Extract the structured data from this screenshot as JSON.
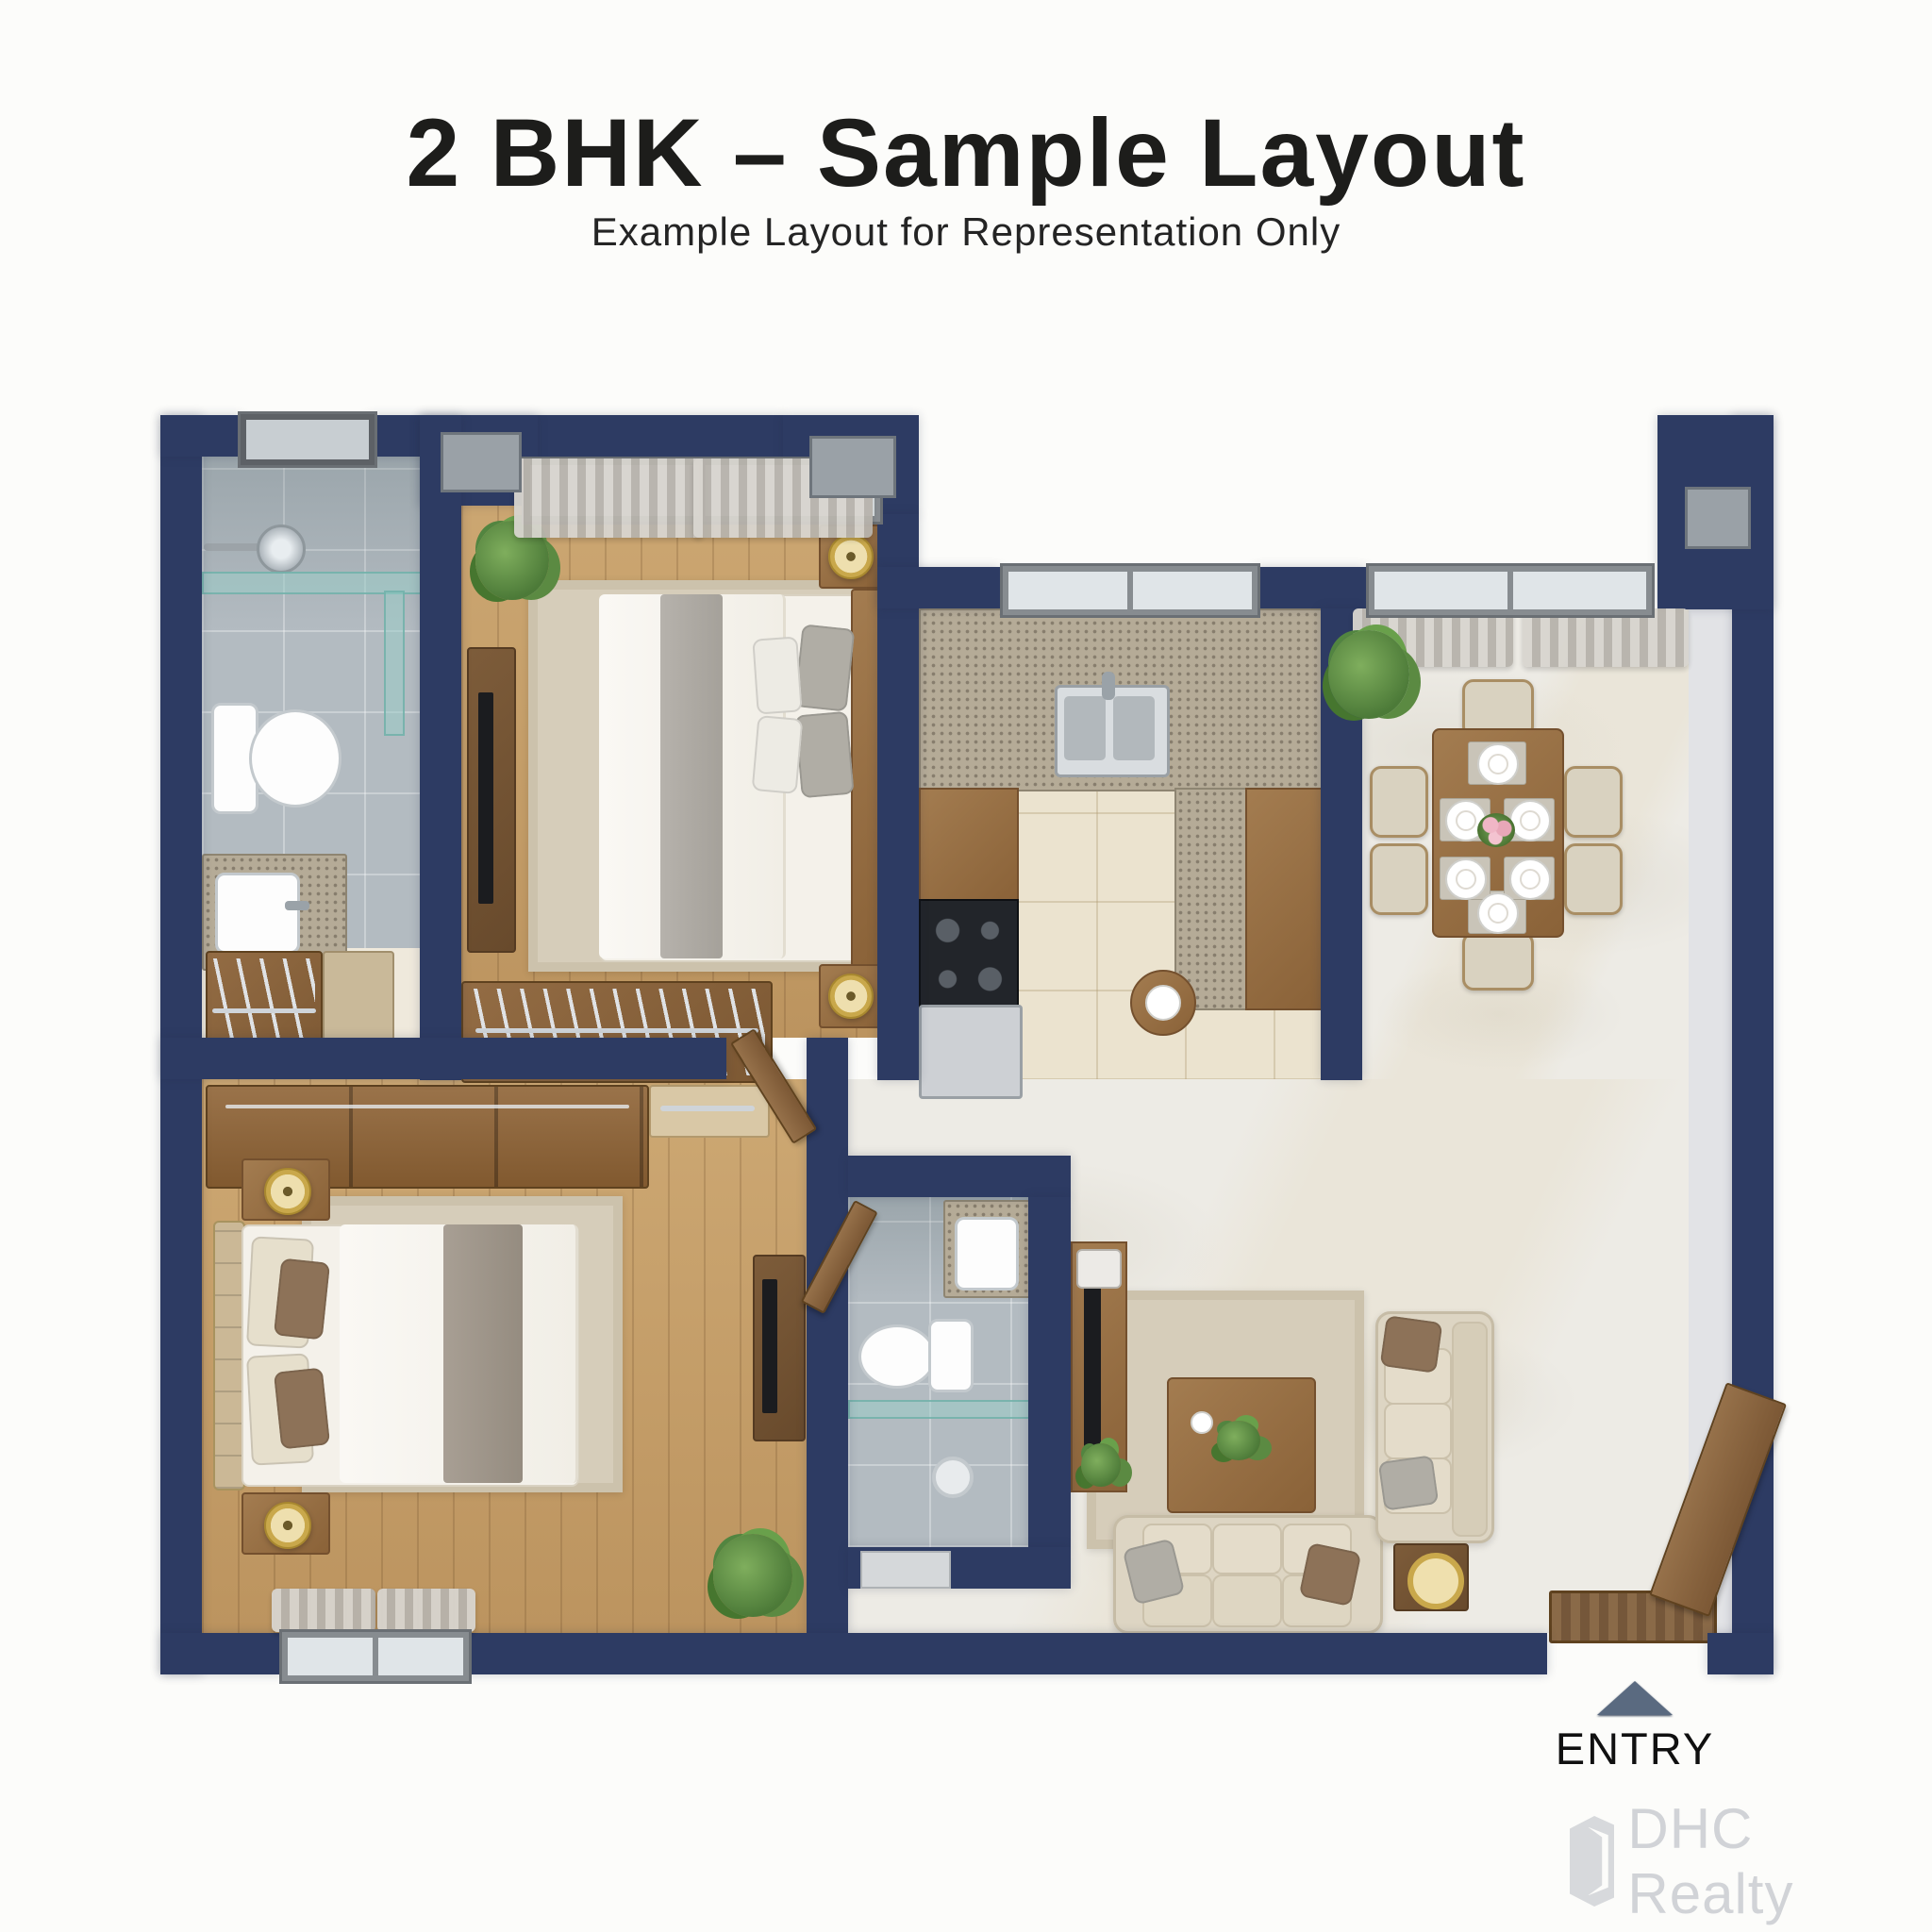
{
  "header": {
    "title": "2 BHK – Sample Layout",
    "subtitle": "Example Layout for Representation Only"
  },
  "entry": {
    "label": "ENTRY",
    "arrow_icon": "up-triangle-icon",
    "arrow_color": "#5a6a80"
  },
  "watermark": {
    "brand": "DHC Realty",
    "logo_icon": "building-logo-icon",
    "color": "#d1d3d7"
  },
  "colors": {
    "background": "#fcfcfa",
    "wall": "#2d3b63",
    "wood_floor": "#c5a06b",
    "marble_floor": "#edebe5",
    "bathroom_tile": "#b3bbc1",
    "kitchen_tile": "#ebe3cf",
    "furniture_wood": "#8a6238",
    "fabric_beige": "#ddd5c3",
    "accent_gold": "#c9a84b",
    "title_text": "#1d1d1b"
  },
  "rooms": [
    {
      "id": "bathroom-1",
      "floor": "gray-tile"
    },
    {
      "id": "walk-in-closet",
      "floor": "cream"
    },
    {
      "id": "bedroom-1",
      "floor": "wood"
    },
    {
      "id": "kitchen",
      "floor": "cream-tile"
    },
    {
      "id": "dining-area",
      "floor": "marble"
    },
    {
      "id": "master-bedroom",
      "floor": "wood"
    },
    {
      "id": "bathroom-2",
      "floor": "gray-tile"
    },
    {
      "id": "living-room",
      "floor": "marble"
    },
    {
      "id": "foyer-corridor",
      "floor": "marble"
    }
  ],
  "icons": [
    "up-triangle-icon",
    "building-logo-icon",
    "shower-icon",
    "toilet-icon",
    "sink-icon",
    "vanity-icon",
    "bed-icon",
    "pillow-icon",
    "nightstand-icon",
    "lamp-icon",
    "plant-icon",
    "wardrobe-icon",
    "tv-icon",
    "stove-icon",
    "fridge-icon",
    "kitchen-sink-icon",
    "dining-table-icon",
    "chair-icon",
    "plate-icon",
    "flower-icon",
    "sofa-icon",
    "coffee-table-icon",
    "side-table-icon",
    "door-icon",
    "doormat-icon",
    "window-icon",
    "curtain-icon",
    "rug-icon",
    "glass-partition-icon"
  ]
}
